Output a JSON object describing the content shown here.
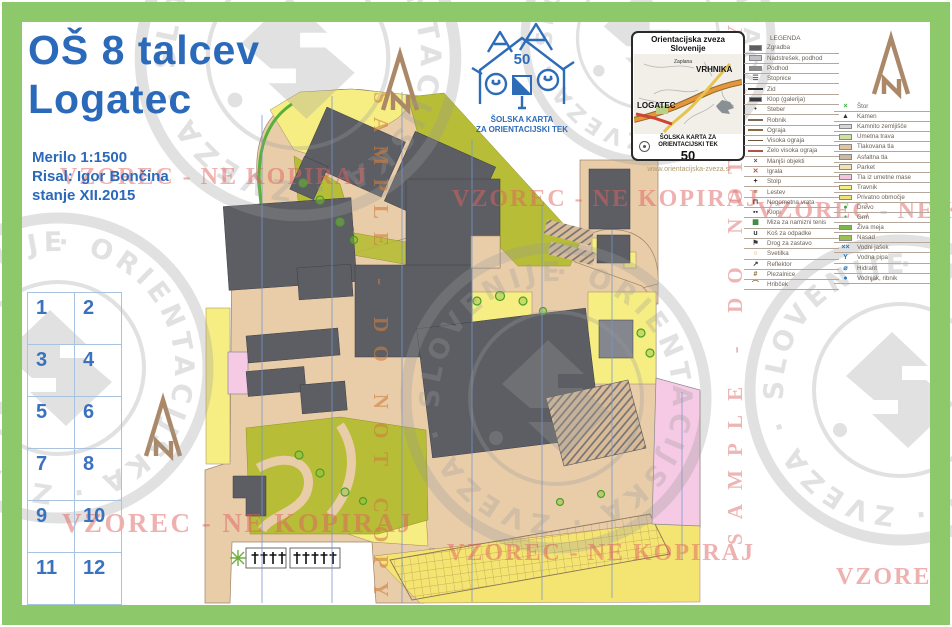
{
  "title": {
    "line1": "OŠ 8 talcev",
    "line2": "Logatec"
  },
  "info": {
    "scale": "Merilo 1:1500",
    "author": "Risal: Igor Bončina",
    "status": "stanje XII.2015"
  },
  "logo": {
    "number": "50",
    "caption_line1": "ŠOLSKA KARTA",
    "caption_line2": "ZA ORIENTACIJSKI TEK"
  },
  "inset": {
    "title": "Orientacijska zveza Slovenije",
    "place_top": "VRHNIKA",
    "place_small": "Zaplana",
    "place_left": "LOGATEC",
    "caption_line1": "ŠOLSKA KARTA ZA",
    "caption_line2": "ORIENTACIJSKI TEK",
    "number": "50",
    "url": "www.orientacijska-zveza.si"
  },
  "watermarks": {
    "vzorec": "VZOREC - NE KOPIRAJ",
    "sample": "SAMPLE - DO NOT COPY",
    "stamp": "· ORIENTACIJSKA · ZVEZA · SLOVENIJE"
  },
  "grid": {
    "numbers": [
      "1",
      "2",
      "3",
      "4",
      "5",
      "6",
      "7",
      "8",
      "9",
      "10",
      "11",
      "12"
    ]
  },
  "legend": {
    "header": "LEGENDA",
    "left": [
      {
        "label": "Zgradba",
        "icon": {
          "type": "swatch",
          "color": "#5c5e64"
        }
      },
      {
        "label": "Nadstrešek, podhod",
        "icon": {
          "type": "swatch",
          "color": "#c2c2c6"
        }
      },
      {
        "label": "Podhod",
        "icon": {
          "type": "swatch",
          "color": "#8a8d92"
        }
      },
      {
        "label": "Stopnice",
        "icon": {
          "type": "glyph",
          "char": "☰",
          "color": "#555555"
        }
      },
      {
        "label": "Zid",
        "icon": {
          "type": "line",
          "color": "#333333"
        }
      },
      {
        "label": "Klop (galerija)",
        "icon": {
          "type": "swatch",
          "color": "#3a3a3e"
        }
      },
      {
        "label": "Steber",
        "icon": {
          "type": "glyph",
          "char": "•",
          "color": "#333333"
        }
      },
      {
        "label": "Robnik",
        "icon": {
          "type": "line",
          "color": "#7a6a58"
        }
      },
      {
        "label": "Ograja",
        "icon": {
          "type": "line",
          "color": "#8a6d3b"
        }
      },
      {
        "label": "Visoka ograja",
        "icon": {
          "type": "line",
          "color": "#6b553f"
        }
      },
      {
        "label": "Zelo visoka ograja",
        "icon": {
          "type": "line",
          "color": "#b05544"
        }
      },
      {
        "label": "Manjši objekti",
        "icon": {
          "type": "glyph",
          "char": "×",
          "color": "#555555"
        }
      },
      {
        "label": "Igrala",
        "icon": {
          "type": "glyph",
          "char": "✕",
          "color": "#b05544"
        }
      },
      {
        "label": "Stolp",
        "icon": {
          "type": "glyph",
          "char": "+",
          "color": "#222222"
        }
      },
      {
        "label": "Lestev",
        "icon": {
          "type": "glyph",
          "char": "≡",
          "color": "#8a6d3b"
        }
      },
      {
        "label": "Nogometna vrata",
        "icon": {
          "type": "glyph",
          "char": "⊓",
          "color": "#333333"
        }
      },
      {
        "label": "Klopi",
        "icon": {
          "type": "glyph",
          "char": "▪▪",
          "color": "#333333"
        }
      },
      {
        "label": "Miza za namizni tenis",
        "icon": {
          "type": "glyph",
          "char": "▦",
          "color": "#2e7d32"
        }
      },
      {
        "label": "Koš za odpadke",
        "icon": {
          "type": "glyph",
          "char": "u",
          "color": "#333333"
        }
      },
      {
        "label": "Drog za zastavo",
        "icon": {
          "type": "glyph",
          "char": "⚑",
          "color": "#333333"
        }
      },
      {
        "label": "Svetilka",
        "icon": {
          "type": "glyph",
          "char": "○",
          "color": "#c59a2f"
        }
      },
      {
        "label": "Reflektor",
        "icon": {
          "type": "glyph",
          "char": "↗",
          "color": "#333333"
        }
      },
      {
        "label": "Plezalnice",
        "icon": {
          "type": "glyph",
          "char": "#",
          "color": "#8a6d3b"
        }
      },
      {
        "label": "Hribček",
        "icon": {
          "type": "glyph",
          "char": "⌒",
          "color": "#8a6d3b"
        }
      }
    ],
    "right": [
      {
        "label": "Štor",
        "icon": {
          "type": "glyph",
          "char": "×",
          "color": "#3aa83a"
        }
      },
      {
        "label": "Kamen",
        "icon": {
          "type": "glyph",
          "char": "▲",
          "color": "#333333"
        }
      },
      {
        "label": "Kamnito zemljišče",
        "icon": {
          "type": "swatch",
          "color": "#d6d6d6"
        }
      },
      {
        "label": "Umetna trava",
        "icon": {
          "type": "swatch",
          "color": "#cfe3a0"
        }
      },
      {
        "label": "Tlakovana tla",
        "icon": {
          "type": "swatch",
          "color": "#e2c49e"
        }
      },
      {
        "label": "Asfaltna tla",
        "icon": {
          "type": "swatch",
          "color": "#c9b9a5"
        }
      },
      {
        "label": "Parket",
        "icon": {
          "type": "swatch",
          "color": "#f2e3b2"
        }
      },
      {
        "label": "Tla iz umetne mase",
        "icon": {
          "type": "swatch",
          "color": "#f3c5df"
        }
      },
      {
        "label": "Travnik",
        "icon": {
          "type": "swatch",
          "color": "#f7ee83"
        }
      },
      {
        "label": "Privatno območje",
        "icon": {
          "type": "swatch",
          "color": "#efe27a"
        }
      },
      {
        "label": "Drevo",
        "icon": {
          "type": "glyph",
          "char": "●",
          "color": "#3aa83a"
        }
      },
      {
        "label": "Grm",
        "icon": {
          "type": "glyph",
          "char": "•",
          "color": "#3aa83a"
        }
      },
      {
        "label": "Živa meja",
        "icon": {
          "type": "swatch",
          "color": "#7ab648"
        }
      },
      {
        "label": "Nasad",
        "icon": {
          "type": "swatch",
          "color": "#9cc14e"
        }
      },
      {
        "label": "Vodni jašek",
        "icon": {
          "type": "glyph",
          "char": "××",
          "color": "#2277cc"
        }
      },
      {
        "label": "Vodna pipa",
        "icon": {
          "type": "glyph",
          "char": "Y",
          "color": "#2277cc"
        }
      },
      {
        "label": "Hidrant",
        "icon": {
          "type": "glyph",
          "char": "⌀",
          "color": "#2277cc"
        }
      },
      {
        "label": "Vodnjak, ribnik",
        "icon": {
          "type": "glyph",
          "char": "●",
          "color": "#2277cc"
        }
      }
    ]
  },
  "map": {
    "colors": {
      "frame_green": "#8dc86a",
      "building": "#5c5e64",
      "paved": "#e9cda9",
      "grass_olive": "#b7bd36",
      "open_yellow": "#f7ee83",
      "private_pink": "#f6c9e4",
      "meridian_blue": "#7796cc",
      "title_blue": "#2b69ba",
      "watermark_red": "#e06363",
      "north_arrow": "#ab8968"
    }
  }
}
